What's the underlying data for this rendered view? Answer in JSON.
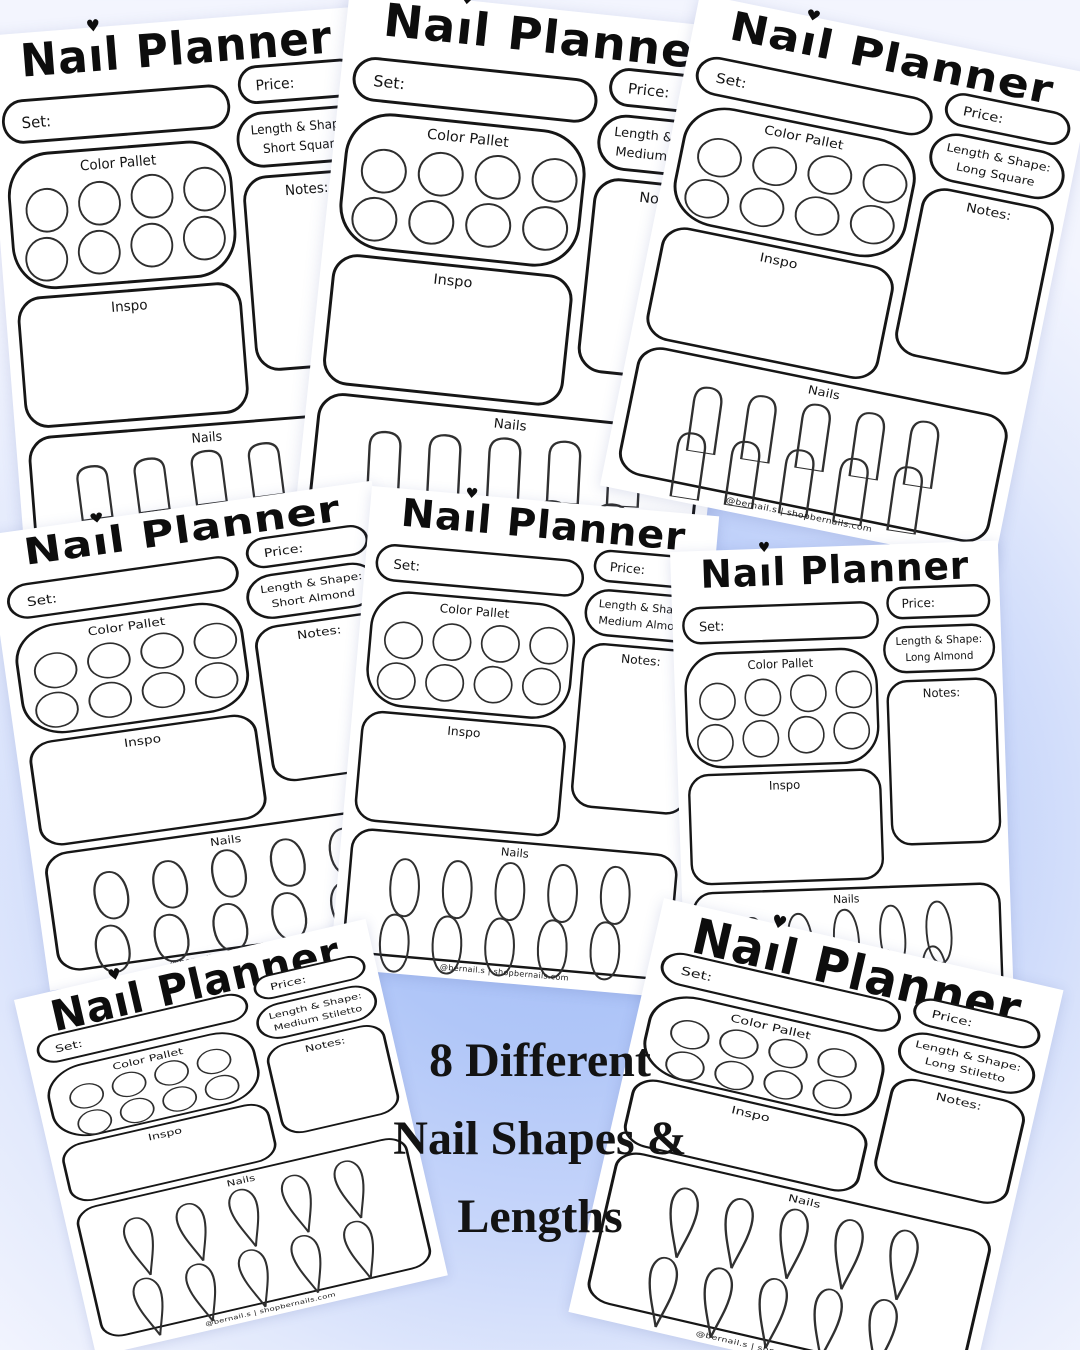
{
  "overlay": {
    "line1": "8 Different",
    "line2": "Nail Shapes &",
    "line3": "Lengths"
  },
  "labels": {
    "title": "Nail Planner",
    "title_a": "Na",
    "title_b": "ıl Planner",
    "heart": "♥",
    "set": "Set:",
    "price": "Price:",
    "length_shape": "Length & Shape:",
    "color_pallet": "Color Pallet",
    "inspo": "Inspo",
    "notes": "Notes:",
    "nails": "Nails",
    "footer": "@bernail.s | shopbernails.com"
  },
  "colors": {
    "background_center": "#a4bef6",
    "background_edge": "#f3f5fe",
    "page": "#ffffff",
    "ink": "#161616"
  },
  "planners": [
    {
      "shape": "Short Square",
      "nail_shape": "square",
      "nail_length": "short"
    },
    {
      "shape": "Medium Square",
      "nail_shape": "square",
      "nail_length": "medium"
    },
    {
      "shape": "Long Square",
      "nail_shape": "square",
      "nail_length": "long"
    },
    {
      "shape": "Short Almond",
      "nail_shape": "almond",
      "nail_length": "short"
    },
    {
      "shape": "Medium Almond",
      "nail_shape": "almond",
      "nail_length": "medium"
    },
    {
      "shape": "Long Almond",
      "nail_shape": "almond",
      "nail_length": "long"
    },
    {
      "shape": "Medium Stiletto",
      "nail_shape": "stiletto",
      "nail_length": "medium"
    },
    {
      "shape": "Long Stiletto",
      "nail_shape": "stiletto",
      "nail_length": "long"
    }
  ]
}
